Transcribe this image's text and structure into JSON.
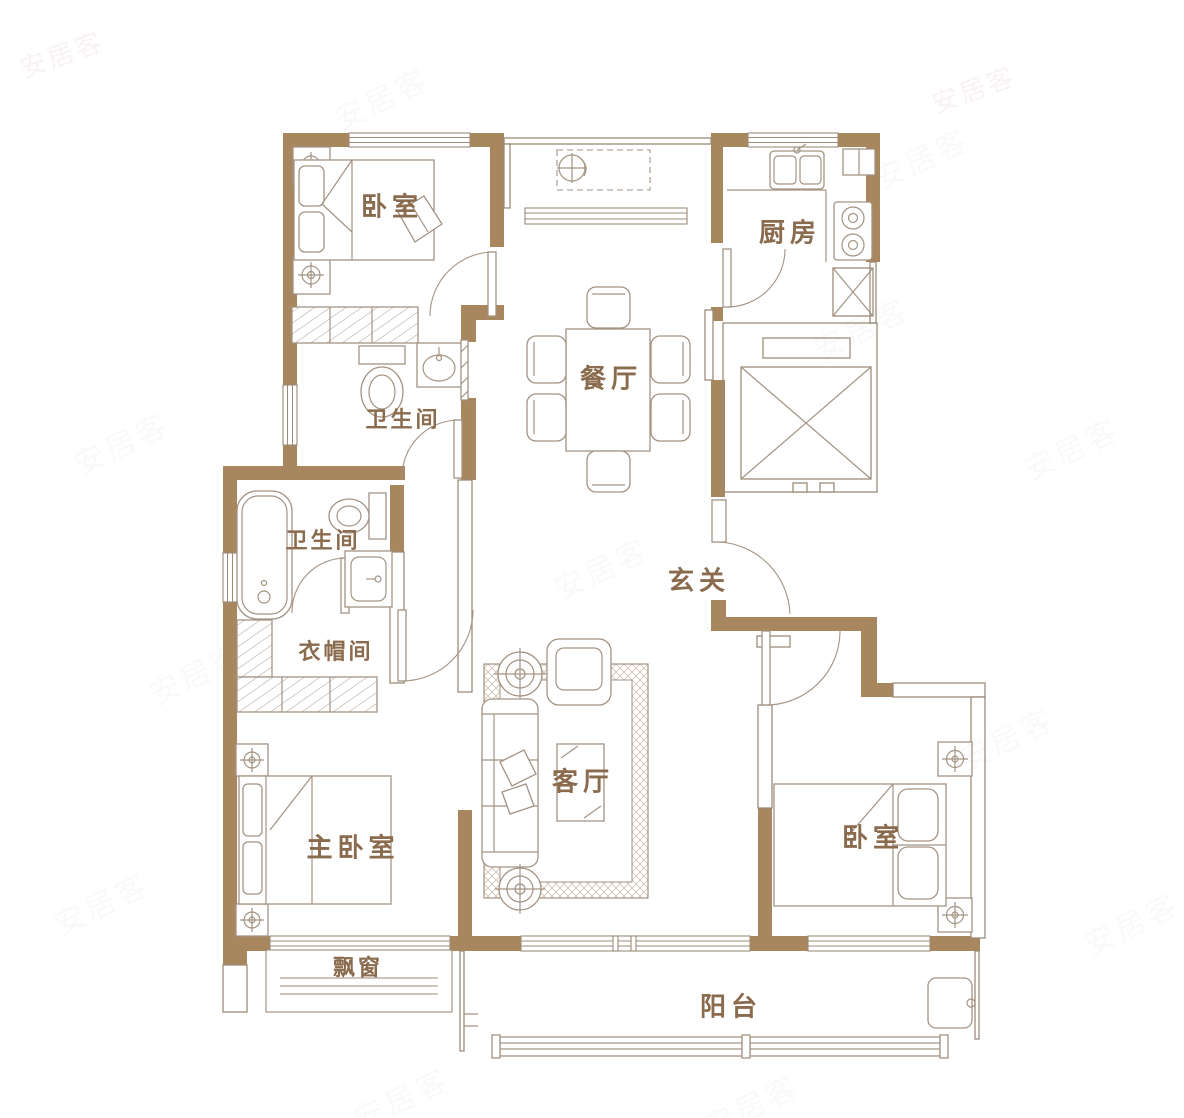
{
  "meta": {
    "kind": "residential floor plan"
  },
  "colors": {
    "wall": "#a8875e",
    "line": "#9b8b78",
    "furniture": "#a39383",
    "label": "#8a6b4d",
    "hatch": "#c3b49e",
    "background": "#ffffff",
    "watermark": "#c59a9a"
  },
  "watermark": {
    "text": "安居客"
  },
  "rooms": {
    "bedroom_top": {
      "label": "卧室"
    },
    "kitchen": {
      "label": "厨房"
    },
    "dining": {
      "label": "餐厅"
    },
    "bath1": {
      "label": "卫生间"
    },
    "bath2": {
      "label": "卫生间"
    },
    "entry": {
      "label": "玄关"
    },
    "cloakroom": {
      "label": "衣帽间"
    },
    "master": {
      "label": "主卧室"
    },
    "living": {
      "label": "客厅"
    },
    "bedroom_right": {
      "label": "卧室"
    },
    "bay_window": {
      "label": "飘窗"
    },
    "balcony": {
      "label": "阳台"
    }
  }
}
